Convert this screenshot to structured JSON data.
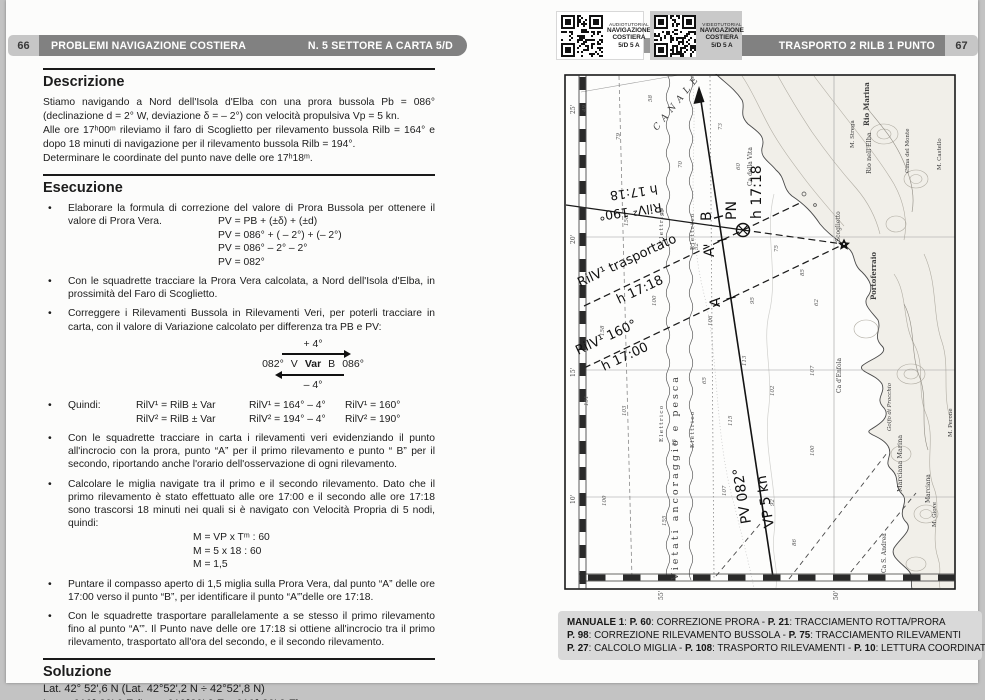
{
  "colors": {
    "header_bar": "#818181",
    "tab_bg": "#c6c6c6",
    "manuale_bg": "#d9d9d9",
    "page_bg": "#fcfcfb",
    "surround": "#c3c3c3",
    "ink": "#1c1c1c"
  },
  "page_left": {
    "page_number": "66",
    "header_title": "PROBLEMI NAVIGAZIONE COSTIERA",
    "header_sub": "N. 5 SETTORE A CARTA 5/D",
    "descrizione": {
      "title": "Descrizione",
      "paragraphs": [
        "Stiamo navigando a Nord dell'Isola d'Elba con una prora bussola Pb = 086° (declinazione d = 2° W, deviazione δ = – 2°) con velocità propulsiva Vp = 5 kn.",
        "Alle ore 17ʰ00ᵐ rileviamo il faro di Scoglietto per rilevamento bussola Rilb = 164° e dopo 18 minuti di navigazione per il rilevamento bussola Rilb = 194°.",
        "Determinare le coordinate del punto nave delle ore 17ʰ18ᵐ."
      ]
    },
    "esecuzione": {
      "title": "Esecuzione",
      "bullets": [
        {
          "text": "Elaborare la formula di correzione del valore di Prora Bussola per ottenere il valore di Prora Vera.",
          "formulas": [
            "PV = PB + (±δ) + (±d)",
            "PV = 086° + ( – 2°) + (– 2°)",
            "PV = 086° – 2° – 2°",
            "PV = 082°"
          ],
          "pull": true
        },
        {
          "text": "Con le squadrette tracciare la Prora Vera calcolata, a Nord dell'Isola d'Elba, in prossimità del Faro di Scoglietto."
        },
        {
          "text": "Correggere i Rilevamenti Bussola in Rilevamenti Veri, per poterli tracciare in carta, con il valore di Variazione calcolato per differenza tra PB e PV:",
          "diagram": "var"
        },
        {
          "quindi": true
        },
        {
          "text": "Con le squadrette tracciare in carta i rilevamenti veri evidenziando il punto all'incrocio con la prora, punto “A” per il primo rilevamento e punto “ B” per il secondo, riportando anche l'orario dell'osservazione di ogni rilevamento."
        },
        {
          "text": "Calcolare le miglia navigate tra il primo e il secondo rilevamento. Dato che il primo rilevamento è stato effettuato alle ore 17:00 e il secondo alle ore 17:18 sono trascorsi 18 minuti nei quali si è navigato con Velocità Propria di 5 nodi, quindi:",
          "formulas": [
            "M = VP x Tᵐ : 60",
            "M = 5 x 18 : 60",
            "M = 1,5"
          ],
          "mclass": true
        },
        {
          "text": "Puntare il compasso aperto di 1,5 miglia sulla Prora Vera, dal punto “A” delle ore 17:00 verso il punto “B”, per identificare il punto “A'”delle ore 17:18."
        },
        {
          "text": "Con le squadrette trasportare parallelamente a se stesso il primo rilevamento fino al punto “A'”. Il Punto nave delle ore 17:18 si ottiene all'incrocio tra il primo rilevamento, trasportato all'ora del secondo, e il secondo rilevamento."
        }
      ],
      "var_diagram": {
        "top": "+ 4°",
        "mid": [
          "082°",
          "V",
          "Var",
          "B",
          "086°"
        ],
        "bottom": "– 4°"
      },
      "quindi": {
        "label": "Quindi:",
        "rows": [
          [
            "RilV¹ = RilB ± Var",
            "RilV¹ = 164° – 4°",
            "RilV¹ = 160°"
          ],
          [
            "RilV² = RilB ± Var",
            "RilV² = 194° – 4°",
            "RilV² = 190°"
          ]
        ]
      }
    },
    "soluzione": {
      "title": "Soluzione",
      "lines": [
        "Lat. 42° 52',6 N (Lat. 42°52',2 N ÷ 42°52',8 N)",
        "Long. 010° 20',6 E (Long 010°20',3 E ÷ 010° 20',9 E)"
      ]
    }
  },
  "page_right": {
    "page_number": "67",
    "header_title": "TRASPORTO 2 RILB 1 PUNTO",
    "qr_audio": {
      "line1": "AUDIOTUTORIAL",
      "line2": "NAVIGAZIONE COSTIERA",
      "line3": "5/D  5 A"
    },
    "qr_video": {
      "line1": "VIDEOTUTORIAL",
      "line2": "NAVIGAZIONE COSTIERA",
      "line3": "5/D  5 A"
    },
    "manuale": {
      "lines": [
        [
          {
            "b": 1,
            "t": "MANUALE 1"
          },
          {
            "b": 0,
            "t": ":  "
          },
          {
            "b": 1,
            "t": "P. 60"
          },
          {
            "b": 0,
            "t": ": CORREZIONE PRORA - "
          },
          {
            "b": 1,
            "t": "P. 21"
          },
          {
            "b": 0,
            "t": ": TRACCIAMENTO ROTTA/PRORA"
          }
        ],
        [
          {
            "b": 1,
            "t": "P. 98"
          },
          {
            "b": 0,
            "t": ": CORREZIONE RILEVAMENTO BUSSOLA - "
          },
          {
            "b": 1,
            "t": "P. 75"
          },
          {
            "b": 0,
            "t": ": TRACCIAMENTO RILEVAMENTI"
          }
        ],
        [
          {
            "b": 1,
            "t": "P. 27"
          },
          {
            "b": 0,
            "t": ": CALCOLO MIGLIA - "
          },
          {
            "b": 1,
            "t": "P. 108"
          },
          {
            "b": 0,
            "t": ": TRASPORTO RILEVAMENTI - "
          },
          {
            "b": 1,
            "t": "P. 10"
          },
          {
            "b": 0,
            "t": ": LETTURA COORDINATE"
          }
        ]
      ]
    },
    "chart": {
      "nav_labels": [
        {
          "t": "RilV¹ trasportato",
          "x": 16,
          "y": 213,
          "r": -25,
          "s": 13
        },
        {
          "t": "h 17:18",
          "x": 55,
          "y": 230,
          "r": -25,
          "s": 13
        },
        {
          "t": "RilV¹ 160°",
          "x": 14,
          "y": 281,
          "r": -25,
          "s": 13
        },
        {
          "t": "h 17:00",
          "x": 40,
          "y": 297,
          "r": -25,
          "s": 13
        },
        {
          "t": "RilV² 190°",
          "x": 97,
          "y": 129,
          "r": 172,
          "s": 12.5
        },
        {
          "t": "h 17:18",
          "x": 93,
          "y": 111,
          "r": 172,
          "s": 12.5
        },
        {
          "t": "PV 082°",
          "x": 187,
          "y": 449,
          "r": -99,
          "s": 14
        },
        {
          "t": "VP 5 kn",
          "x": 210,
          "y": 453,
          "r": -99,
          "s": 14
        },
        {
          "t": "PN",
          "x": 172,
          "y": 146,
          "r": -90,
          "s": 14
        },
        {
          "t": "h 17:18",
          "x": 197,
          "y": 145,
          "r": -90,
          "s": 14
        },
        {
          "t": "B",
          "x": 147,
          "y": 147,
          "r": -90,
          "s": 14
        },
        {
          "t": "A'",
          "x": 150,
          "y": 183,
          "r": -90,
          "s": 14
        },
        {
          "t": "A",
          "x": 156,
          "y": 233,
          "r": -90,
          "s": 14
        }
      ],
      "geo_labels": [
        {
          "t": "CANALE",
          "x": 93,
          "y": 57,
          "r": -51,
          "s": 9,
          "ls": 5,
          "i": 1
        },
        {
          "t": "Vietati ancoraggio e pesca",
          "x": 114,
          "y": 506,
          "r": -90,
          "s": 9.5,
          "ls": 3
        },
        {
          "t": "Elettrico",
          "x": 99,
          "y": 368,
          "r": -90,
          "s": 5.5,
          "ls": 1.5
        },
        {
          "t": "Elettrico",
          "x": 130,
          "y": 374,
          "r": -90,
          "s": 5.5,
          "ls": 1.5
        },
        {
          "t": "Elettrico",
          "x": 99,
          "y": 170,
          "r": -90,
          "s": 5.5,
          "ls": 1.5
        },
        {
          "t": "Elettrico",
          "x": 130,
          "y": 176,
          "r": -90,
          "s": 5.5,
          "ls": 1.5
        },
        {
          "t": "Rio Marina",
          "x": 305,
          "y": 52,
          "r": -90,
          "s": 7,
          "b": 1
        },
        {
          "t": "M. Strega",
          "x": 290,
          "y": 74,
          "r": -90,
          "s": 5.5
        },
        {
          "t": "Rio nell'Elba",
          "x": 307,
          "y": 100,
          "r": -90,
          "s": 6.5
        },
        {
          "t": "Cima del Monte",
          "x": 345,
          "y": 99,
          "r": -90,
          "s": 5.5
        },
        {
          "t": "M. Castello",
          "x": 377,
          "y": 96,
          "r": -90,
          "s": 5.5
        },
        {
          "t": "Ca della Vita",
          "x": 188,
          "y": 112,
          "r": -90,
          "s": 6
        },
        {
          "t": "Scoglietto",
          "x": 276,
          "y": 168,
          "r": -90,
          "s": 6
        },
        {
          "t": "Portoferraio",
          "x": 312,
          "y": 226,
          "r": -90,
          "s": 7,
          "b": 1
        },
        {
          "t": "Ca d'Enfola",
          "x": 277,
          "y": 319,
          "r": -90,
          "s": 6
        },
        {
          "t": "Golfo di Procchio",
          "x": 327,
          "y": 357,
          "r": -90,
          "s": 5.5,
          "i": 1
        },
        {
          "t": "Marciana Marina",
          "x": 338,
          "y": 418,
          "r": -90,
          "s": 6.5
        },
        {
          "t": "Marciana",
          "x": 366,
          "y": 429,
          "r": -90,
          "s": 6
        },
        {
          "t": "M. Giove",
          "x": 372,
          "y": 453,
          "r": -90,
          "s": 5.5
        },
        {
          "t": "Ca S. Andrea",
          "x": 322,
          "y": 499,
          "r": -90,
          "s": 6
        },
        {
          "t": "M. Perone",
          "x": 388,
          "y": 363,
          "r": -90,
          "s": 5.5
        }
      ],
      "depths": [
        {
          "v": "49",
          "x": 22,
          "y": 38
        },
        {
          "v": "58",
          "x": 88,
          "y": 28
        },
        {
          "v": "79",
          "x": 56,
          "y": 66
        },
        {
          "v": "73",
          "x": 158,
          "y": 56
        },
        {
          "v": "70",
          "x": 118,
          "y": 94
        },
        {
          "v": "90",
          "x": 100,
          "y": 142
        },
        {
          "v": "158",
          "x": 64,
          "y": 152
        },
        {
          "v": "52",
          "x": 134,
          "y": 176
        },
        {
          "v": "60",
          "x": 176,
          "y": 96
        },
        {
          "v": "75",
          "x": 214,
          "y": 178
        },
        {
          "v": "95",
          "x": 190,
          "y": 230
        },
        {
          "v": "100",
          "x": 92,
          "y": 232
        },
        {
          "v": "106",
          "x": 148,
          "y": 252
        },
        {
          "v": "113",
          "x": 182,
          "y": 292
        },
        {
          "v": "158",
          "x": 40,
          "y": 262
        },
        {
          "v": "103",
          "x": 62,
          "y": 342
        },
        {
          "v": "85",
          "x": 112,
          "y": 372
        },
        {
          "v": "115",
          "x": 168,
          "y": 352
        },
        {
          "v": "102",
          "x": 210,
          "y": 322
        },
        {
          "v": "100",
          "x": 42,
          "y": 432
        },
        {
          "v": "155",
          "x": 102,
          "y": 452
        },
        {
          "v": "107",
          "x": 162,
          "y": 422
        },
        {
          "v": "92",
          "x": 210,
          "y": 432
        },
        {
          "v": "86",
          "x": 232,
          "y": 472
        },
        {
          "v": "107",
          "x": 250,
          "y": 302
        },
        {
          "v": "62",
          "x": 254,
          "y": 232
        },
        {
          "v": "85",
          "x": 240,
          "y": 202
        },
        {
          "v": "100",
          "x": 250,
          "y": 382
        },
        {
          "v": "151",
          "x": 24,
          "y": 332
        },
        {
          "v": "65",
          "x": 142,
          "y": 310
        }
      ],
      "scale_left": [
        {
          "t": "25'",
          "y": 40
        },
        {
          "t": "20'",
          "y": 170
        },
        {
          "t": "15'",
          "y": 303
        },
        {
          "t": "10'",
          "y": 430
        }
      ],
      "scale_bottom": [
        {
          "t": "55'",
          "x": 99
        },
        {
          "t": "50'",
          "x": 274
        }
      ]
    }
  }
}
